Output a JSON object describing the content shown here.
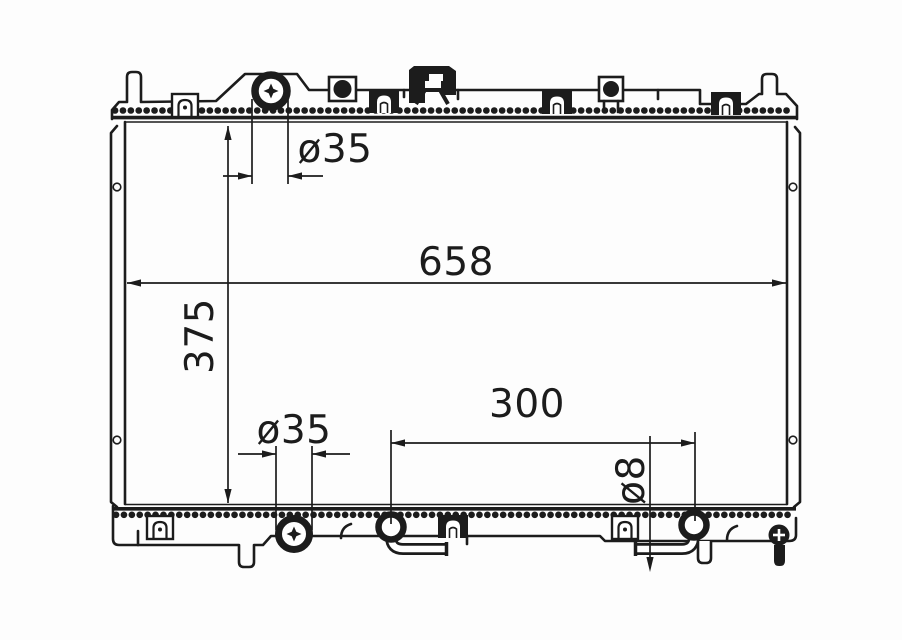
{
  "page": {
    "background": "#fdfdfd",
    "line_color": "#1c1c1c",
    "content_type": "radiator front-view engineering drawing"
  },
  "drawing": {
    "labels": {
      "filler_diameter_top": "ø35",
      "core_width": "658",
      "core_height": "375",
      "filler_diameter_bottom": "ø35",
      "fitting_spacing": "300",
      "pipe_diameter": "ø8"
    }
  }
}
